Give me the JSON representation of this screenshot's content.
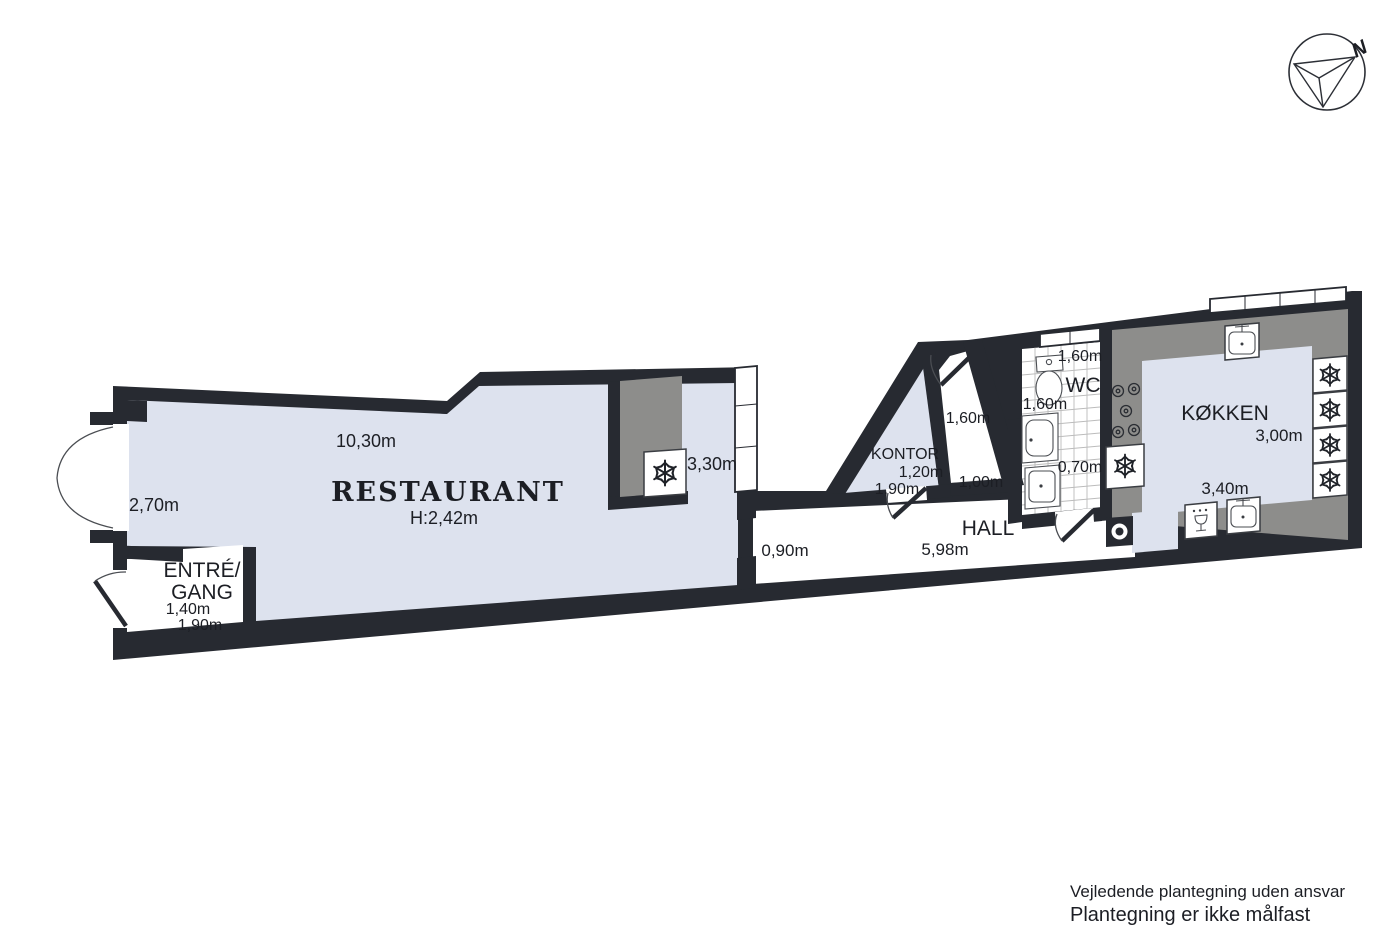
{
  "floorplan": {
    "compass": {
      "label": "N"
    },
    "colors": {
      "wall": "#272a31",
      "floor_blue": "#dde2ee",
      "counter_grey": "#8d8d8b",
      "background": "#ffffff"
    },
    "rooms": {
      "restaurant": {
        "name": "RESTAURANT",
        "ceiling_height": "H:2,42m",
        "dim_top": "10,30m",
        "dim_left": "2,70m",
        "dim_right": "3,30m"
      },
      "entre": {
        "name_line1": "ENTRÉ/",
        "name_line2": "GANG",
        "dim1": "1,40m",
        "dim2": "1,90m"
      },
      "hall": {
        "name": "HALL",
        "dim_door": "0,90m",
        "dim_length": "5,98m"
      },
      "kontor": {
        "name": "KONTOR",
        "dim1": "1,20m",
        "dim2": "1,90m"
      },
      "mellemgang": {
        "dim1": "1,60m",
        "dim2": "1,00m"
      },
      "wc": {
        "name": "WC",
        "dim_top": "1,60m",
        "dim_left": "1,60m",
        "dim_bottom": "0,70m"
      },
      "kokken": {
        "name": "KØKKEN",
        "dim_right": "3,00m",
        "dim_bottom": "3,40m"
      }
    },
    "disclaimer": {
      "line1": "Vejledende plantegning uden ansvar",
      "line2": "Plantegning er ikke målfast"
    }
  }
}
